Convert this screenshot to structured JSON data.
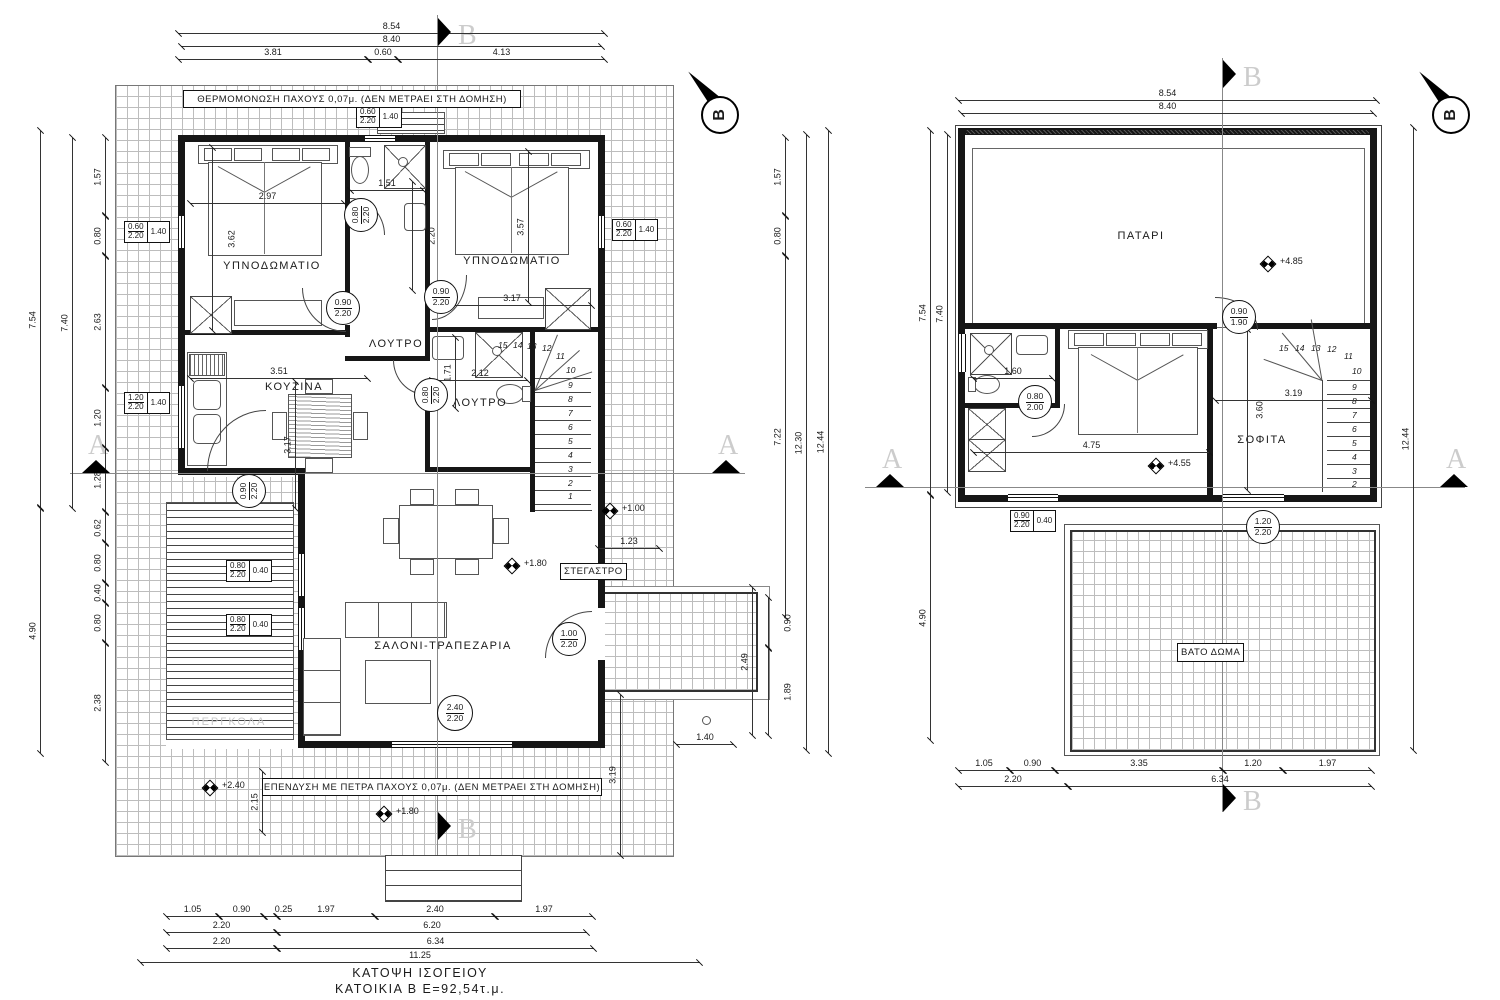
{
  "sheet": {
    "background": "#ffffff",
    "line_color": "#1a1a1a"
  },
  "title": {
    "line1": "ΚΑΤΟΨΗ ΙΣΟΓΕΙΟΥ",
    "line2": "ΚΑΤΟΙΚΙΑ Β Ε=92,54τ.μ."
  },
  "notes": {
    "insulation": "ΘΕΡΜΟΜΟΝΩΣΗ ΠΑΧΟΥΣ 0,07μ. (ΔΕΝ ΜΕΤΡΑΕΙ ΣΤΗ ΔΟΜΗΣΗ)",
    "stone": "ΕΠΕΝΔΥΣΗ ΜΕ ΠΕΤΡΑ ΠΑΧΟΥΣ 0,07μ. (ΔΕΝ ΜΕΤΡΑΕΙ ΣΤΗ ΔΟΜΗΣΗ)"
  },
  "section": {
    "a": "A",
    "b": "B"
  },
  "north": {
    "label": "B"
  },
  "ground": {
    "rooms": {
      "bedroom1": "ΥΠΝΟΔΩΜΑΤΙΟ",
      "bedroom2": "ΥΠΝΟΔΩΜΑΤΙΟ",
      "bath1": "ΛΟΥΤΡΟ",
      "bath2": "ΛΟΥΤΡΟ",
      "kitchen": "ΚΟΥΖΙΝΑ",
      "living": "ΣΑΛΟΝΙ-ΤΡΑΠΕΖΑΡΙΑ",
      "canopy": "ΣΤΕΓΑΣΤΡΟ",
      "pergola": "ΠΕΡΓΚΟΛΑ"
    },
    "dim": {
      "top_total": "8.54",
      "top_inner": "8.40",
      "top_a": "3.81",
      "top_b": "0.60",
      "top_c": "4.13",
      "left_total": "7.54",
      "left_inner": "7.40",
      "left_lower": "4.90",
      "l1": "1.57",
      "l2": "0.80",
      "l3": "2.63",
      "l4": "1.20",
      "l5": "1.28",
      "l6": "0.62",
      "l7": "0.80",
      "l8": "0.40",
      "l9": "0.80",
      "l10": "2.38",
      "r1": "1.57",
      "r2": "0.80",
      "r3": "7.22",
      "r_mid": "12.30",
      "r_total": "12.44",
      "porch_total": "2.49",
      "porch_a": "0.90",
      "porch_b": "1.89",
      "porch_d": "3.19",
      "porch_w": "1.40",
      "canopy_w": "1.23",
      "deck_h": "2.15",
      "b1": "1.05",
      "b2": "0.90",
      "b3": "0.25",
      "b4": "1.97",
      "b5": "2.40",
      "b6": "1.97",
      "b7": "2.20",
      "b8": "6.20",
      "b9": "2.20",
      "b10": "6.34",
      "b_total": "11.25",
      "bed1_w": "2.97",
      "bed1_h": "3.62",
      "bath1_w": "1.51",
      "bath1_h": "2.20",
      "bed2_w": "3.17",
      "bed2_h": "3.57",
      "kit_w": "3.51",
      "kit_h": "3.17",
      "bath2_h": "1.71",
      "bath2_w": "2.12"
    },
    "levels": {
      "entry": "+1.00",
      "living": "+1.80",
      "deck": "+2.40",
      "front": "+1.80"
    },
    "doors": {
      "bath1_w": "0.80",
      "bath1_h": "2.20",
      "bed1_w": "0.90",
      "bed1_h": "2.20",
      "bed2_w": "0.90",
      "bed2_h": "2.20",
      "bath2_w": "0.80",
      "bath2_h": "2.20",
      "kitchen_w": "0.90",
      "kitchen_h": "2.20",
      "entry_w": "1.00",
      "entry_h": "2.20",
      "window_w": "2.40",
      "window_h": "2.20"
    },
    "windows": {
      "top_w": "0.60",
      "top_h": "2.20",
      "top_sill": "1.40",
      "bed1_w": "0.60",
      "bed1_h": "2.20",
      "bed1_sill": "1.40",
      "bed2_w": "0.60",
      "bed2_h": "2.20",
      "bed2_sill": "1.40",
      "kit_w": "1.20",
      "kit_h": "2.20",
      "kit_sill": "1.40",
      "liv1_w": "0.80",
      "liv1_h": "2.20",
      "liv1_sill": "0.40",
      "liv2_w": "0.80",
      "liv2_h": "2.20",
      "liv2_sill": "0.40"
    },
    "stairs": [
      "1",
      "2",
      "3",
      "4",
      "5",
      "6",
      "7",
      "8",
      "9",
      "10",
      "11",
      "12",
      "13",
      "14",
      "15"
    ]
  },
  "upper": {
    "rooms": {
      "loft": "ΠΑΤΑΡΙ",
      "attic": "ΣΟΦΙΤΑ",
      "roof": "ΒΑΤΟ ΔΩΜΑ"
    },
    "dim": {
      "top_total": "8.54",
      "top_inner": "8.40",
      "left_total": "7.54",
      "left_inner": "7.40",
      "left_lower": "4.90",
      "right_total": "12.44",
      "bath": "1.60",
      "bed": "4.75",
      "hall_w": "3.19",
      "hall_h": "3.60",
      "b1": "1.05",
      "b2": "0.90",
      "b3": "3.35",
      "b4": "1.20",
      "b5": "1.97",
      "b6": "2.20",
      "b7": "6.34"
    },
    "levels": {
      "loft": "+4.85",
      "bed": "+4.55"
    },
    "doors": {
      "loft_w": "0.90",
      "loft_h": "1.90",
      "bath_w": "0.80",
      "bath_h": "2.00",
      "win_w": "1.20",
      "win_h": "2.20"
    },
    "windows": {
      "south_w": "0.90",
      "south_h": "2.20",
      "south_sill": "0.40"
    },
    "stairs": [
      "2",
      "3",
      "4",
      "5",
      "6",
      "7",
      "8",
      "9",
      "10",
      "11",
      "12",
      "13",
      "14",
      "15"
    ]
  }
}
